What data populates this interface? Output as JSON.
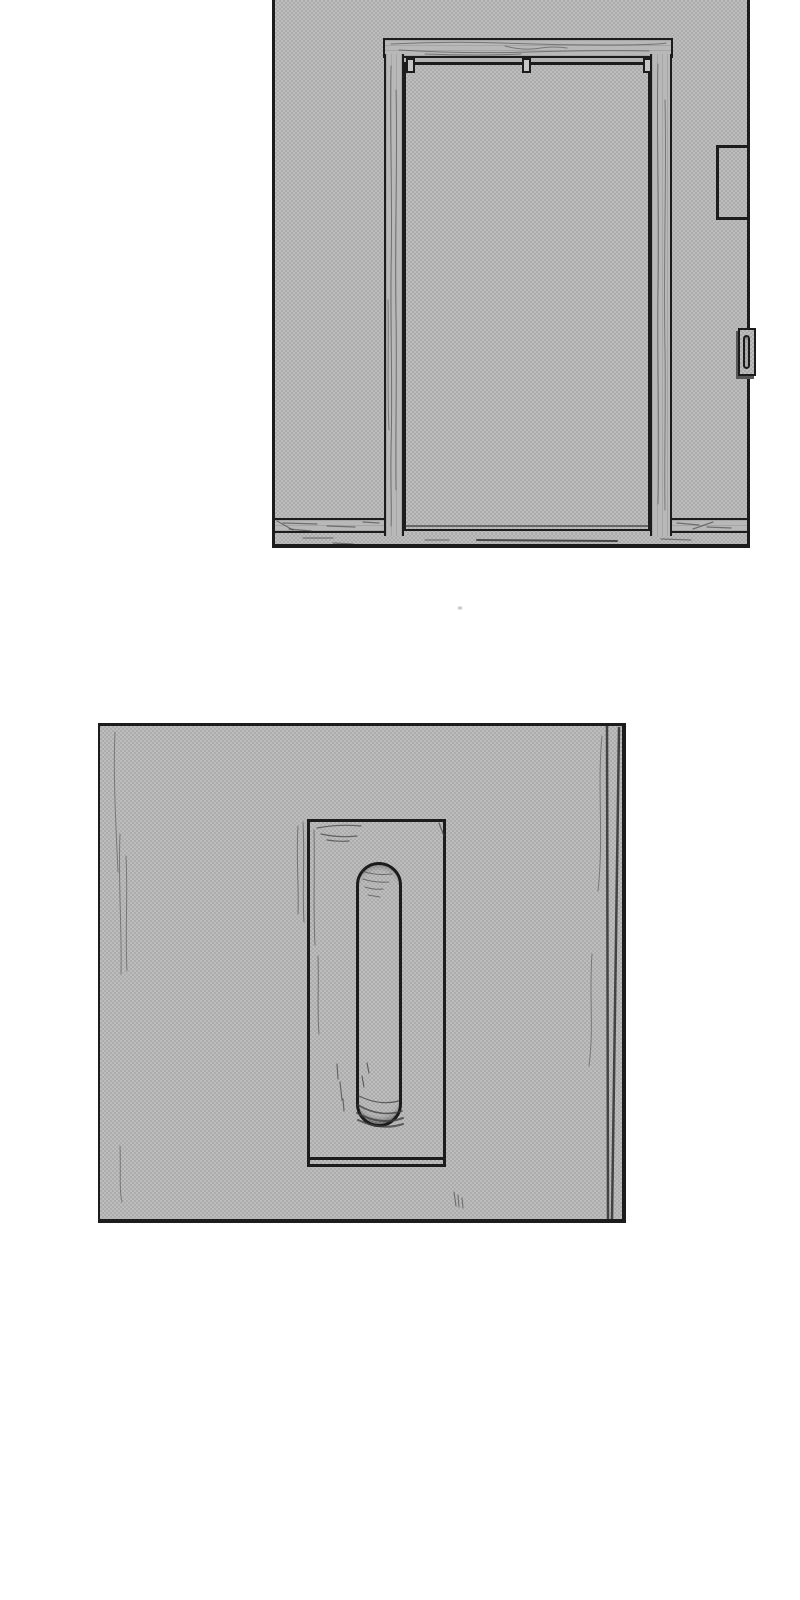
{
  "scene": {
    "kind": "manga page, two borderless-background panels, no dialogue text",
    "panels": [
      {
        "label": "sliding-door-wide-shot",
        "description": "A closed sliding door hanging from a top rail inside a wooden frame on a screentoned wall; recessed pull handle on the right side of the door; small panel box on the right wall; baseboard and floor strip at the bottom."
      },
      {
        "label": "door-handle-closeup",
        "description": "Close-up of the sliding door face showing the rectangular handle plate with a tall rounded recessed pull slot; door edge visible at right."
      }
    ]
  },
  "colors": {
    "paper": "#ffffff",
    "ink": "#1c1c1c",
    "tone-base": "#bdbdbd",
    "tone-dot": "#a7a7a7",
    "wood": "#b8b8b8",
    "track-gap": "#b2b2b2",
    "hanger": "#c6c6c6",
    "shadow": "#565656",
    "grain": "#3c3c3c",
    "speck": "#cccccc"
  }
}
